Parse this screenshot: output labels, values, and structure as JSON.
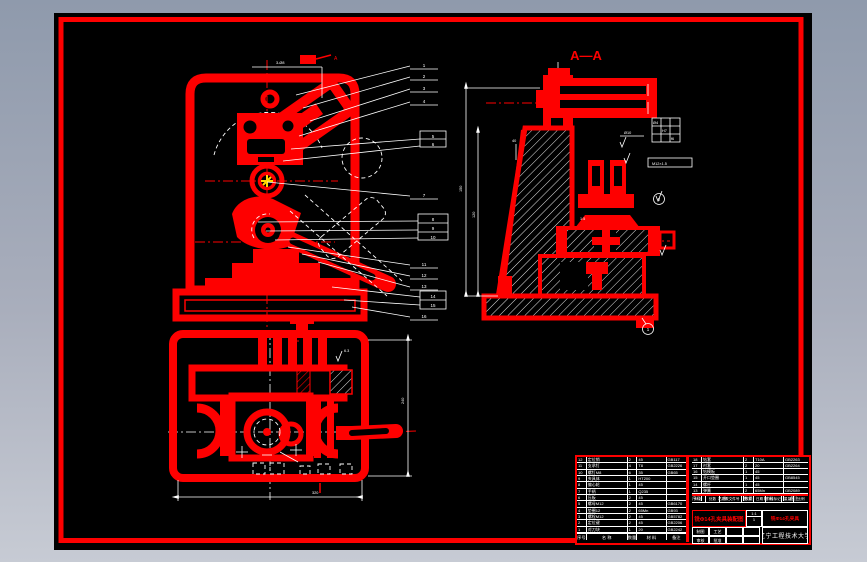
{
  "palette": {
    "accent": "#fe0000",
    "sheet": "#000000",
    "bg_top": "#8f9aac",
    "bg_bottom": "#c7cbd4",
    "ucs": "#ffd800"
  },
  "section_view": {
    "label": "A—A",
    "taper": "1:5",
    "dim_h1": "150",
    "dim_h2": "120",
    "dim_d1": "Ø10",
    "dim_d2": "40",
    "fit": {
      "a": "Ø4",
      "b": "H7",
      "c": "f6"
    },
    "frame_note": "M12×1.5",
    "balloons": [
      "1",
      "2"
    ]
  },
  "front_view": {
    "flag": "A",
    "top_dim": "3-Ø8",
    "callouts": [
      "1",
      "2",
      "3",
      "4",
      "5",
      "6",
      "7",
      "8",
      "9",
      "10",
      "11",
      "12",
      "13",
      "14",
      "15",
      "16"
    ]
  },
  "plan_view": {
    "dim_w": "320",
    "dim_h": "240",
    "finish": "6.3"
  },
  "bom_left": {
    "header": [
      "序号",
      "名  称",
      "数量",
      "材  料",
      "备注"
    ],
    "rows": [
      [
        "12",
        "定位销",
        "2",
        "45",
        "GB117"
      ],
      [
        "11",
        "支承钉",
        "4",
        "T8",
        "GB2226"
      ],
      [
        "10",
        "螺钉M8",
        "6",
        "35",
        "GB65"
      ],
      [
        "9",
        "夹具体",
        "1",
        "HT200",
        ""
      ],
      [
        "8",
        "偏心轮",
        "1",
        "45",
        ""
      ],
      [
        "7",
        "手柄",
        "1",
        "Q235",
        ""
      ],
      [
        "6",
        "压板",
        "2",
        "45",
        ""
      ],
      [
        "5",
        "螺母M12",
        "2",
        "45",
        "GB6170"
      ],
      [
        "4",
        "垫圈12",
        "2",
        "65Mn",
        "GB93"
      ],
      [
        "3",
        "螺栓M12",
        "2",
        "45",
        "GB5782"
      ],
      [
        "2",
        "定位键",
        "2",
        "45",
        "GB2206"
      ],
      [
        "1",
        "对刀块",
        "1",
        "20",
        "GB2242"
      ]
    ]
  },
  "bom_right": {
    "header": [
      "序号",
      "名  称",
      "数量",
      "材  料",
      "备注"
    ],
    "rows": [
      [
        "18",
        "钻套",
        "2",
        "T10A",
        "GB2263"
      ],
      [
        "17",
        "衬套",
        "2",
        "20",
        "GB2264"
      ],
      [
        "16",
        "钻模板",
        "1",
        "45",
        ""
      ],
      [
        "15",
        "开口垫圈",
        "1",
        "45",
        "GB8545"
      ],
      [
        "14",
        "螺杆",
        "1",
        "45",
        ""
      ],
      [
        "13",
        "弹簧",
        "2",
        "65Mn",
        "GB2089"
      ]
    ]
  },
  "title_block": {
    "org": "辽宁工程技术大学",
    "title": "铣Φ14孔夹具装配图",
    "part": "铣Φ14孔夹具",
    "h1": "标记",
    "h2": "处数",
    "h3": "更改文件号",
    "h4": "签字",
    "h5": "日期",
    "s1": "阶段标记",
    "s2": "重量",
    "s3": "比例",
    "scale": "1:1",
    "qty": "1",
    "c1": "制图",
    "c2": "工艺",
    "c3": "审核",
    "c4": "批准"
  }
}
